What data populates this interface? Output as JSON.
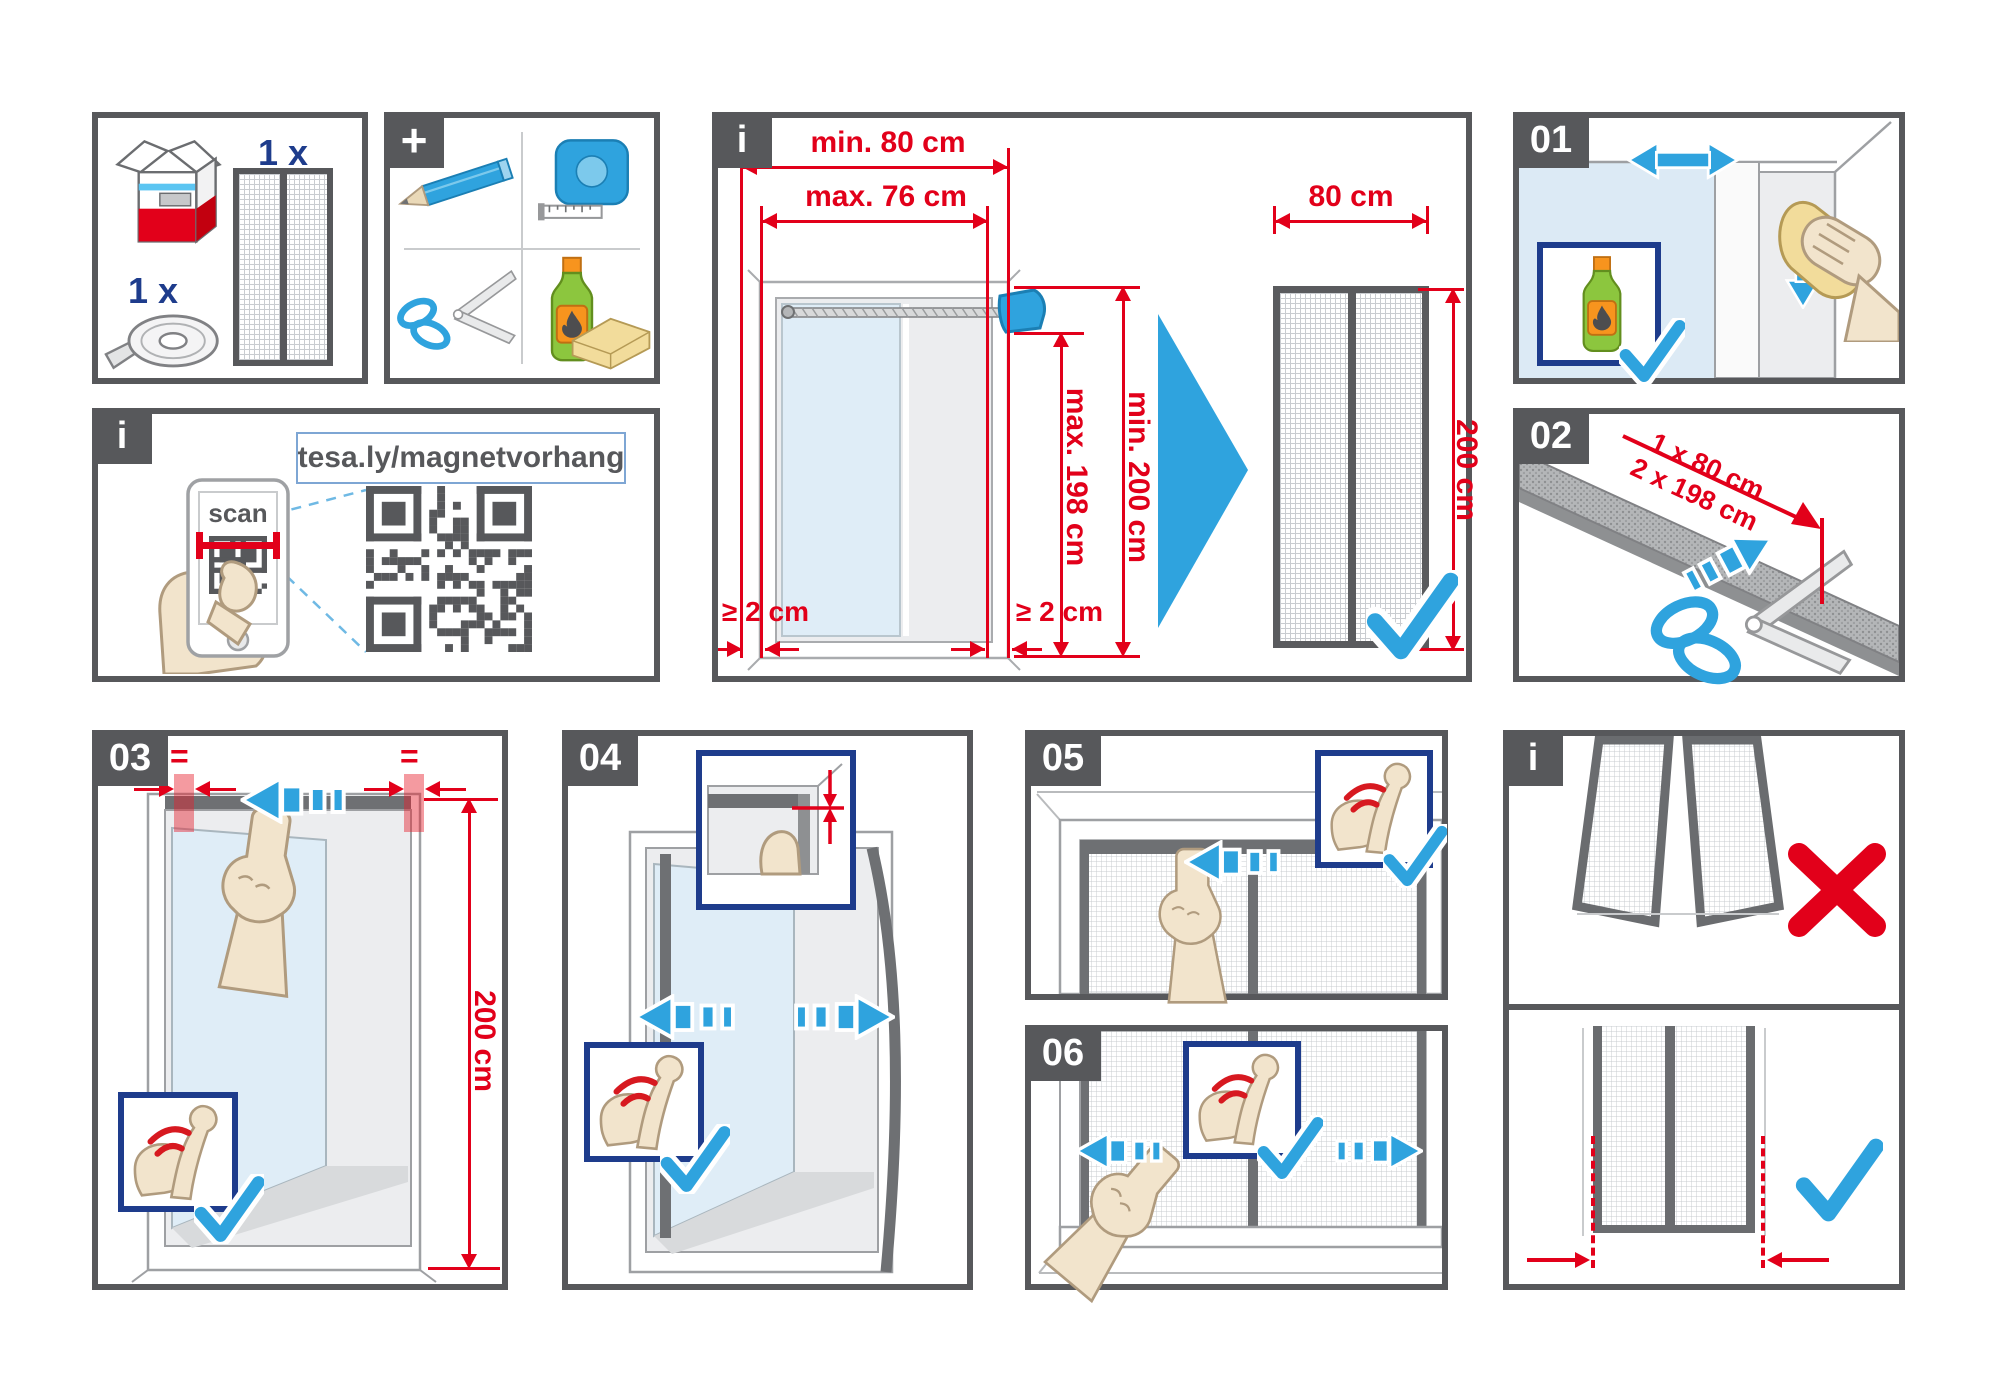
{
  "colors": {
    "dark": "#57585B",
    "red": "#E2001A",
    "blue": "#2FA3DE",
    "navy": "#1E3C8C",
    "glass": "#DFEDF7"
  },
  "panels": {
    "contents": {
      "qty_screen": "1 x",
      "qty_tape": "1 x"
    },
    "tools": {
      "badge": "+"
    },
    "qr": {
      "badge": "i",
      "url": "tesa.ly/magnetvorhang",
      "scan_label": "scan"
    },
    "measure": {
      "badge": "i",
      "outer_width": "min. 80 cm",
      "inner_width": "max. 76 cm",
      "inner_height": "max. 198 cm",
      "outer_height": "min. 200 cm",
      "curtain_width": "80 cm",
      "curtain_height": "200 cm",
      "margin_left": "≥ 2 cm",
      "margin_right": "≥ 2 cm"
    },
    "step01": {
      "badge": "01"
    },
    "step02": {
      "badge": "02",
      "cut_line1": "1 x 80 cm",
      "cut_line2": "2 x 198 cm"
    },
    "step03": {
      "badge": "03",
      "equal_left": "=",
      "equal_right": "=",
      "height": "200 cm"
    },
    "step04": {
      "badge": "04"
    },
    "step05": {
      "badge": "05"
    },
    "step06": {
      "badge": "06"
    },
    "result": {
      "badge": "i"
    }
  }
}
